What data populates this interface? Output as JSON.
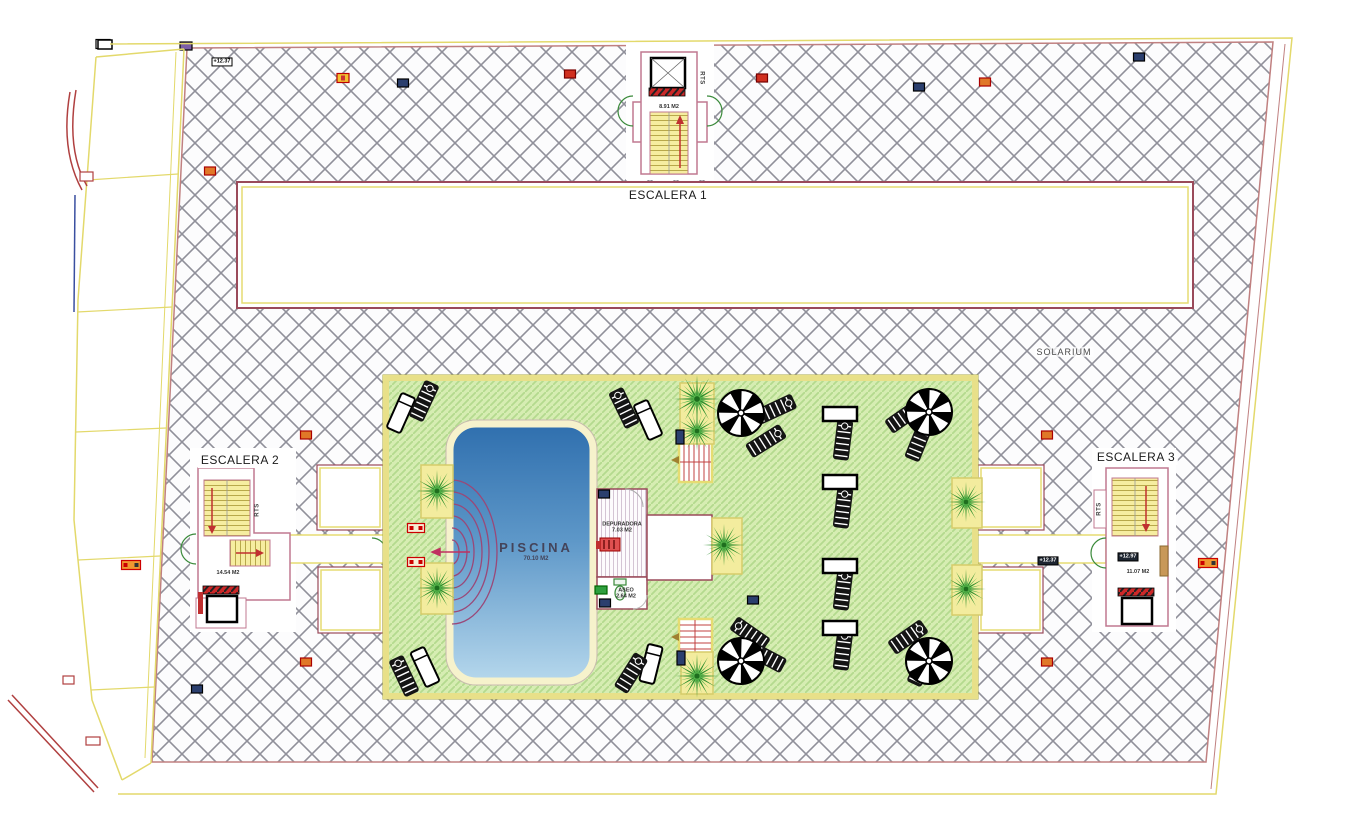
{
  "meta": {
    "width": 1347,
    "height": 825,
    "drawing_type": "roof solarium floor plan"
  },
  "texts": {
    "escalera1": "ESCALERA 1",
    "escalera2": "ESCALERA 2",
    "escalera3": "ESCALERA 3",
    "solarium": "SOLARIUM",
    "piscina": {
      "name": "PISCINA",
      "area": "70.10 M2"
    },
    "depuradora": {
      "name": "DEPURADORA",
      "area": "7.03 M2"
    },
    "aseo": {
      "name": "ASEO",
      "area": "2.64 M2"
    },
    "esc1_area": "8.91 M2",
    "esc2_area": "14.54 M2",
    "esc3_area": "11.07 M2",
    "rts": "RTS",
    "elev_top_left": "+12.37",
    "elev_right": "+12.37",
    "elev_esc3": "+12.97"
  },
  "colors": {
    "boundary_yellow": "#e3d96b",
    "boundary_red": "#b04040",
    "hatch_gray": "#90909a",
    "plan_maroon": "#9a4a5a",
    "room_pink": "#c07890",
    "green_zone": "#d6edb2",
    "pool_dark": "#2f6fae",
    "pool_light": "#b5d7ec",
    "stair_yellow": "#f6eda0",
    "door_green": "#3a8a3a",
    "arrow_red": "#c03030"
  },
  "furniture": {
    "planters": [
      [
        680,
        383,
        34,
        61
      ],
      [
        421,
        465,
        32,
        53
      ],
      [
        421,
        563,
        32,
        51
      ],
      [
        712,
        518,
        30,
        56
      ],
      [
        681,
        652,
        32,
        42
      ],
      [
        952,
        478,
        30,
        50
      ],
      [
        952,
        565,
        30,
        50
      ]
    ],
    "palms": [
      [
        697,
        399,
        1.2
      ],
      [
        697,
        431,
        1.0
      ],
      [
        724,
        545,
        1.05
      ],
      [
        697,
        676,
        1.1
      ],
      [
        966,
        502,
        1.0
      ],
      [
        966,
        589,
        1.0
      ],
      [
        437,
        491,
        1.05
      ],
      [
        437,
        588,
        1.05
      ]
    ],
    "parasols": [
      [
        741,
        413
      ],
      [
        929,
        412
      ],
      [
        741,
        661
      ],
      [
        929,
        661
      ]
    ],
    "white_loungers": [
      [
        401,
        413,
        24
      ],
      [
        648,
        420,
        -24
      ],
      [
        651,
        664,
        14
      ],
      [
        425,
        667,
        -25
      ]
    ],
    "striped_loungers": [
      [
        424,
        401,
        25
      ],
      [
        624,
        408,
        -26
      ],
      [
        776,
        409,
        65
      ],
      [
        766,
        441,
        58
      ],
      [
        905,
        416,
        55
      ],
      [
        919,
        441,
        22
      ],
      [
        750,
        634,
        -55
      ],
      [
        766,
        657,
        -62
      ],
      [
        908,
        637,
        55
      ],
      [
        922,
        666,
        25
      ],
      [
        631,
        673,
        32
      ],
      [
        404,
        676,
        -25
      ],
      [
        843,
        440,
        7
      ],
      [
        843,
        508,
        7
      ],
      [
        843,
        590,
        7
      ],
      [
        843,
        650,
        7
      ]
    ],
    "tables": [
      [
        840,
        414,
        0
      ],
      [
        840,
        482,
        0
      ],
      [
        840,
        566,
        0
      ],
      [
        840,
        628,
        0
      ]
    ]
  },
  "markers": [
    [
      103,
      44,
      "black"
    ],
    [
      186,
      46,
      "purple"
    ],
    [
      343,
      78,
      "yellow"
    ],
    [
      403,
      83,
      "navy"
    ],
    [
      570,
      74,
      "red"
    ],
    [
      762,
      78,
      "red"
    ],
    [
      919,
      87,
      "navy"
    ],
    [
      985,
      82,
      "orange"
    ],
    [
      1139,
      57,
      "navy"
    ],
    [
      210,
      171,
      "orange"
    ],
    [
      306,
      435,
      "orange"
    ],
    [
      306,
      662,
      "orange"
    ],
    [
      1047,
      435,
      "orange"
    ],
    [
      1047,
      662,
      "orange"
    ],
    [
      416,
      528,
      "redio"
    ],
    [
      416,
      562,
      "redio"
    ],
    [
      131,
      565,
      "orangeio"
    ],
    [
      1208,
      563,
      "orangeio"
    ],
    [
      197,
      689,
      "navy"
    ],
    [
      753,
      600,
      "navy"
    ],
    [
      680,
      437,
      "navyv"
    ],
    [
      681,
      658,
      "navyv"
    ],
    [
      604,
      494,
      "navy"
    ],
    [
      605,
      603,
      "navy"
    ],
    [
      601,
      590,
      "green"
    ]
  ]
}
